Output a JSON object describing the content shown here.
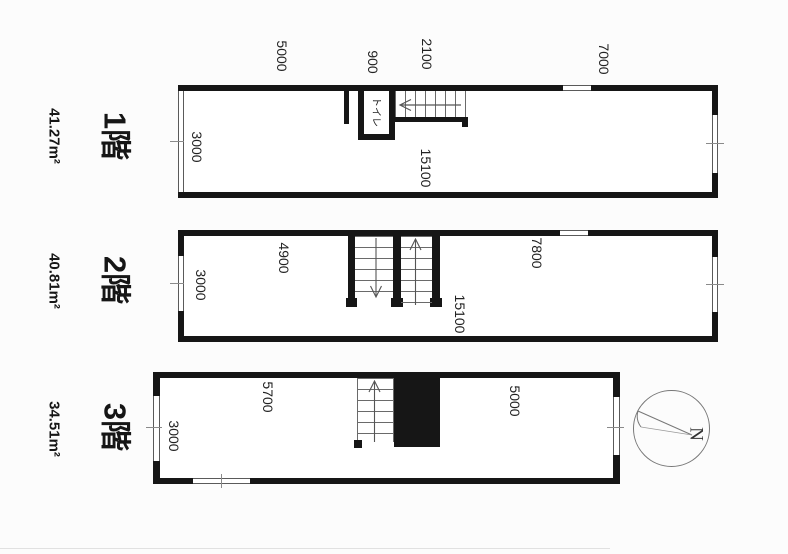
{
  "floors": [
    {
      "name": "1階",
      "area": "41.27m²",
      "dims": {
        "top_left": "5000",
        "toilet_width": "900",
        "stair_width": "2100",
        "top_right": "7000",
        "depth": "3000",
        "length": "15100"
      },
      "rooms": {
        "toilet": "トイレ"
      }
    },
    {
      "name": "2階",
      "area": "40.81m²",
      "dims": {
        "left_section": "4900",
        "right_section": "7800",
        "depth": "3000",
        "length": "15100"
      }
    },
    {
      "name": "3階",
      "area": "34.51m²",
      "dims": {
        "left_section": "5700",
        "right_section": "5000",
        "depth": "3000"
      }
    }
  ],
  "compass": {
    "north_label": "N"
  },
  "colors": {
    "wall": "#161616",
    "paper": "#fcfcfc",
    "line": "#5a5a5a"
  }
}
